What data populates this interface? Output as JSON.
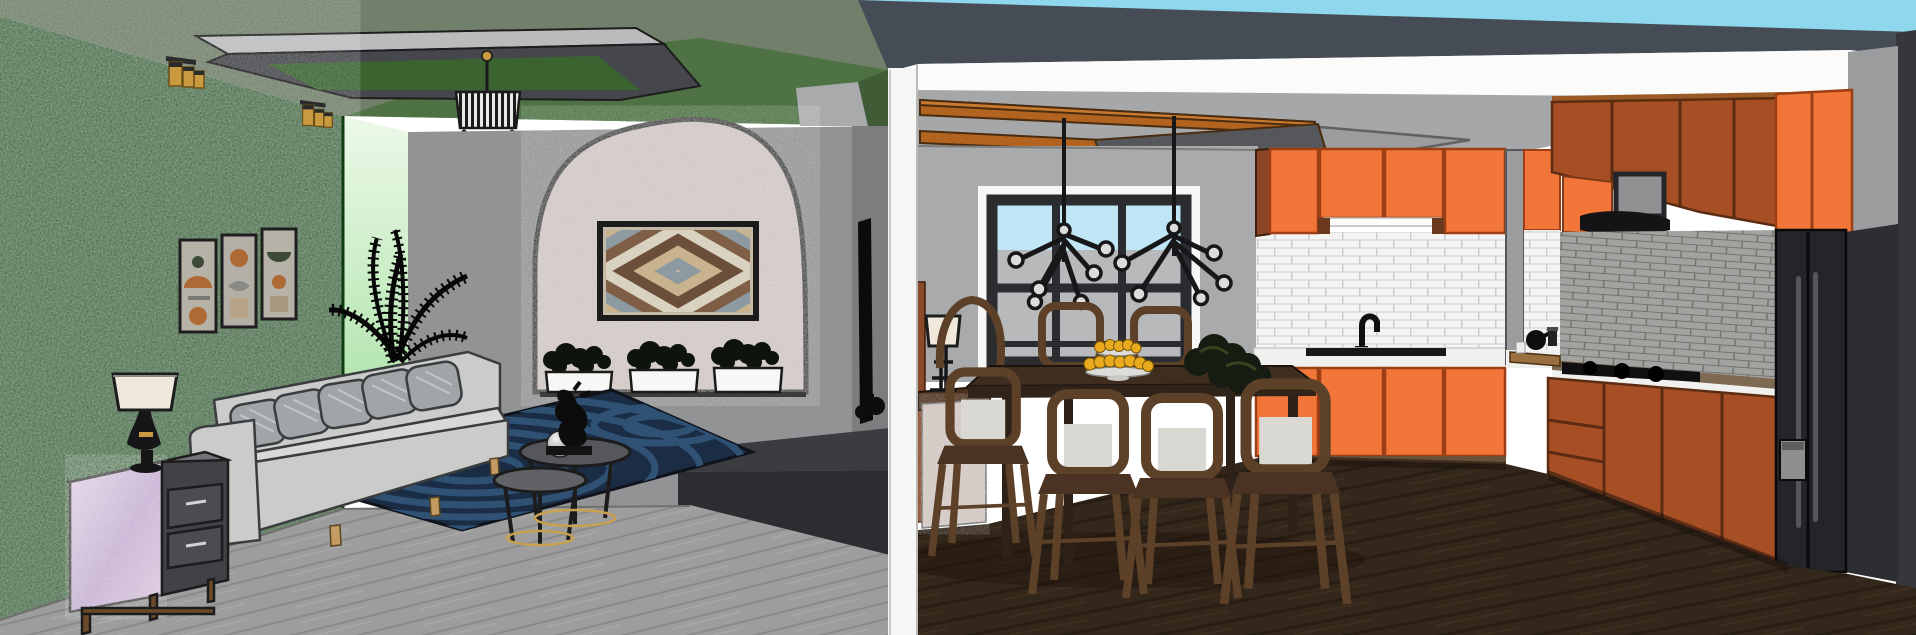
{
  "scene": {
    "left_room": "living room",
    "right_room": "kitchen and dining room",
    "style": "sketchup 3d interior render",
    "objects": [
      "green accent wall",
      "triptych wall art",
      "gold wall sconces",
      "recessed ceiling panel",
      "crystal chandelier",
      "backlit wall panel",
      "palm plant",
      "arched stucco niche",
      "chevron artwork",
      "window planters",
      "gray sofa",
      "throw pillows",
      "nesting coffee tables",
      "abstract sculpture",
      "sphere decor",
      "navy area rug",
      "marble nightstand",
      "table lamp",
      "tv media wall",
      "media console",
      "room divider wall",
      "kitchen window",
      "sputnik chandeliers",
      "ceiling wood beams",
      "dining table",
      "dining chairs",
      "tiered fruit stand",
      "table plant",
      "sideboard",
      "sideboard lamp",
      "orange upper cabinets",
      "white subway tile backsplash",
      "sink and faucet",
      "orange base cabinets",
      "range hood",
      "microwave niche",
      "gas cooktop",
      "gray brick backsplash",
      "rust cabinets",
      "black refrigerator",
      "dark wood kitchen floor",
      "gray wood living floor",
      "sky"
    ]
  },
  "colors": {
    "sky": "#8ed7ec",
    "roof": "#464c55",
    "ceiling_sage": "#72806b",
    "ceiling_green": "#4e7244",
    "panel_light": "#babbbd",
    "panel_dark": "#45474c",
    "panel_recess": "#3a6330",
    "accent_green": "#156117",
    "strip_top": "#ecf9e8",
    "strip_bottom": "#a7e0a3",
    "wall_gray": "#919395",
    "stucco": "#cec4c1",
    "marble_light": "#e4d6e6",
    "marble_dark": "#c4aed2",
    "drawer": "#404247",
    "sofa": "#cbcbc9",
    "sofa_seat": "#d8d8d6",
    "pillow": "#a0a5a8",
    "wood_leg": "#c49b62",
    "rug": "#1b2d45",
    "rug_wave": "#2f5174",
    "floor_left": "#9d9d9d",
    "floor_left_line": "#8a8a8a",
    "media": "#3a3c3f",
    "tv": "#0b0b0d",
    "divider": "#f6f6f4",
    "band_white": "#fbfbf9",
    "ceiling_kitchen": "#a6a7a9",
    "beam": "#b2631f",
    "wall_kitchen": "#a9aaac",
    "window_frame": "#2a2c2f",
    "window_sky": "#bfe6f4",
    "window_ground": "#b7b9bb",
    "cabinet_orange": "#f2763a",
    "cabinet_side_brown": "#8a4526",
    "tile_white": "#f4f4f2",
    "tile_grout": "#cdcdcb",
    "counter_white": "#f0f0ee",
    "cabinet_rust": "#a64e24",
    "brick_gray": "#a2a2a0",
    "brick_grout_gray": "#74746f",
    "hood": "#141416",
    "fridge": "#232529",
    "charcoal": "#35373b",
    "floor_kitchen": "#33261a",
    "floor_kitchen_line": "#271d12",
    "table_wood": "#3f2e20",
    "chair_wood": "#5c4027",
    "chair_cushion": "#d9d8d2",
    "fruit": "#eaaa1f",
    "lamp_shade": "#f0e9db",
    "gold": "#c99a3f",
    "bush": "#0e130b",
    "planter": "#f7f7f5"
  }
}
